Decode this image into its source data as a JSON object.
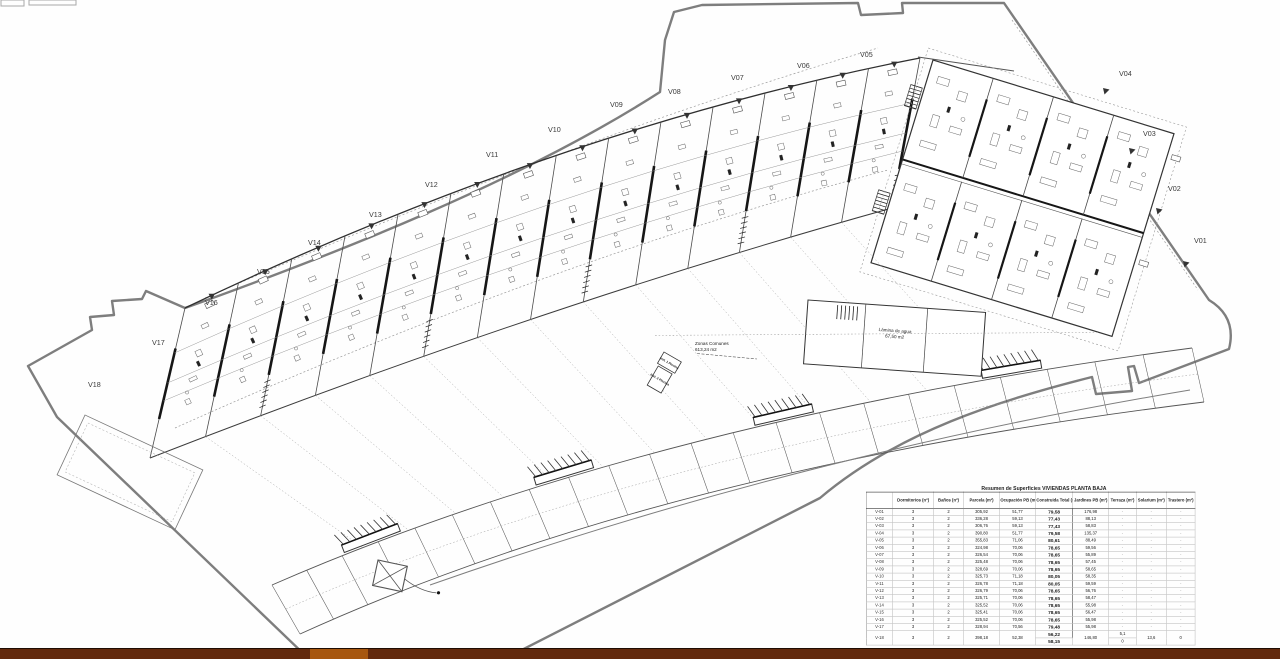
{
  "plan": {
    "villa_labels": [
      {
        "label": "V05",
        "x": 860,
        "y": 57
      },
      {
        "label": "V06",
        "x": 797,
        "y": 68
      },
      {
        "label": "V07",
        "x": 731,
        "y": 80
      },
      {
        "label": "V08",
        "x": 668,
        "y": 94
      },
      {
        "label": "V09",
        "x": 610,
        "y": 107
      },
      {
        "label": "V10",
        "x": 548,
        "y": 132
      },
      {
        "label": "V11",
        "x": 486,
        "y": 157
      },
      {
        "label": "V12",
        "x": 425,
        "y": 187
      },
      {
        "label": "V13",
        "x": 369,
        "y": 217
      },
      {
        "label": "V14",
        "x": 308,
        "y": 245
      },
      {
        "label": "V15",
        "x": 257,
        "y": 274
      },
      {
        "label": "V16",
        "x": 205,
        "y": 305
      },
      {
        "label": "V17",
        "x": 152,
        "y": 345
      },
      {
        "label": "V18",
        "x": 88,
        "y": 387
      },
      {
        "label": "V04",
        "x": 1119,
        "y": 76
      },
      {
        "label": "V03",
        "x": 1143,
        "y": 136
      },
      {
        "label": "V02",
        "x": 1168,
        "y": 191
      },
      {
        "label": "V01",
        "x": 1194,
        "y": 243
      }
    ],
    "area_labels": {
      "zonas_comunes_1": "Zonas Comunes",
      "zonas_comunes_2": "613,24 m2",
      "lamina_1": "Lámina de agua",
      "lamina_2": "67,50 m2",
      "inst_1": "Inst. 1 Piscina",
      "inst_2": "Inst. 2 Piscina"
    },
    "colors": {
      "boundary": "#7e7e7e",
      "wall_dark": "#161616",
      "wall_mid": "#3c3c3c",
      "line_light": "#8a8a8a",
      "bar_brown": "#63290c",
      "bar_accent": "#a7570f"
    }
  },
  "table": {
    "title": "Resumen de Superficies VIVIENDAS PLANTA BAJA",
    "columns": [
      "Dormitorios (nº)",
      "Baños (nº)",
      "Parcela (m²)",
      "Ocupación PB (m²)",
      "Construida Total (m²)",
      "Jardines PB (m²)",
      "Terraza (m²)",
      "Solarium (m²)",
      "Trastero (m²)"
    ],
    "rows": [
      [
        "V-01",
        "3",
        "2",
        "305,92",
        "51,77",
        "79,58",
        "176,98",
        "-",
        "-",
        "-"
      ],
      [
        "V-02",
        "3",
        "2",
        "336,28",
        "59,13",
        "77,43",
        "88,13",
        "-",
        "-",
        "-"
      ],
      [
        "V-03",
        "3",
        "2",
        "306,76",
        "59,13",
        "77,43",
        "58,83",
        "-",
        "-",
        "-"
      ],
      [
        "V-04",
        "3",
        "2",
        "390,80",
        "51,77",
        "79,58",
        "135,37",
        "-",
        "-",
        "-"
      ],
      [
        "V-05",
        "3",
        "2",
        "355,83",
        "71,06",
        "80,61",
        "88,49",
        "-",
        "-",
        "-"
      ],
      [
        "V-06",
        "3",
        "2",
        "324,98",
        "70,06",
        "78,65",
        "59,56",
        "-",
        "-",
        "-"
      ],
      [
        "V-07",
        "3",
        "2",
        "326,54",
        "70,06",
        "78,65",
        "55,89",
        "-",
        "-",
        "-"
      ],
      [
        "V-08",
        "3",
        "2",
        "325,48",
        "70,06",
        "78,65",
        "57,45",
        "-",
        "-",
        "-"
      ],
      [
        "V-09",
        "3",
        "2",
        "328,69",
        "70,06",
        "78,65",
        "58,65",
        "-",
        "-",
        "-"
      ],
      [
        "V-10",
        "3",
        "2",
        "325,73",
        "71,18",
        "80,05",
        "58,35",
        "-",
        "-",
        "-"
      ],
      [
        "V-11",
        "3",
        "2",
        "326,78",
        "71,18",
        "80,05",
        "59,59",
        "-",
        "-",
        "-"
      ],
      [
        "V-12",
        "3",
        "2",
        "326,79",
        "70,06",
        "78,65",
        "56,76",
        "-",
        "-",
        "-"
      ],
      [
        "V-13",
        "3",
        "2",
        "325,71",
        "70,06",
        "78,65",
        "58,47",
        "-",
        "-",
        "-"
      ],
      [
        "V-14",
        "3",
        "2",
        "325,52",
        "70,06",
        "78,65",
        "55,98",
        "-",
        "-",
        "-"
      ],
      [
        "V-15",
        "3",
        "2",
        "325,41",
        "70,06",
        "78,65",
        "56,47",
        "-",
        "-",
        "-"
      ],
      [
        "V-16",
        "3",
        "2",
        "325,52",
        "70,06",
        "78,65",
        "55,98",
        "-",
        "-",
        "-"
      ],
      [
        "V-17",
        "3",
        "2",
        "328,94",
        "70,56",
        "79,48",
        "55,98",
        "-",
        "-",
        "-"
      ]
    ],
    "v18": {
      "label": "V-18",
      "dormitorios": "3",
      "banos": "2",
      "parcela": "398,18",
      "ocupacion": "52,38",
      "construida": [
        "56,22",
        "58,15"
      ],
      "jardines": "146,80",
      "terraza": [
        "5,1",
        "0"
      ],
      "solarium": "13,6",
      "trastero": "0"
    },
    "total_label": "TOTAL PB",
    "total_value": "1457,23"
  }
}
